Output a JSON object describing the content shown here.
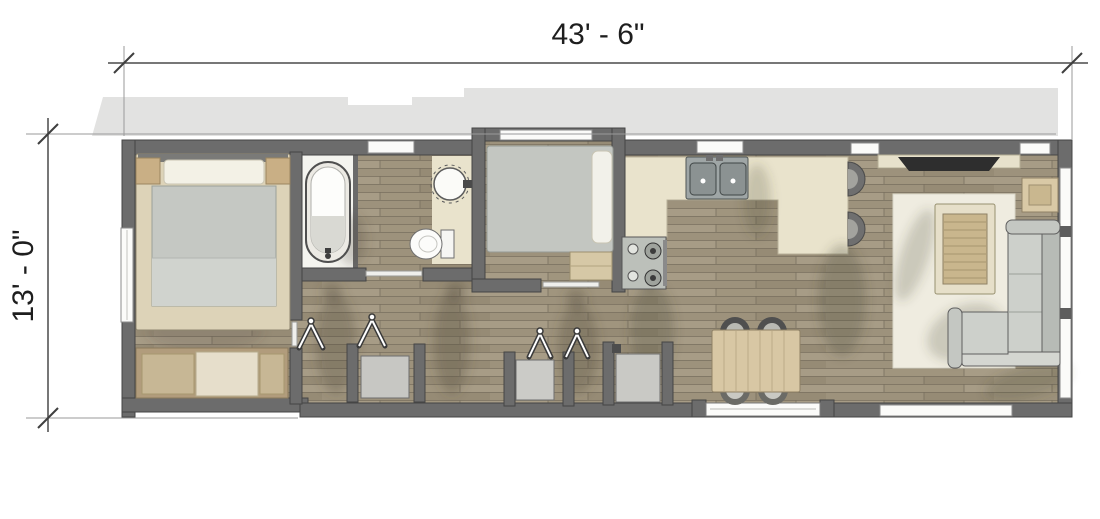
{
  "type": "floor-plan",
  "dimensions": {
    "width_label": "43' - 6\"",
    "height_label": "13' - 0\""
  },
  "colors": {
    "background": "#ffffff",
    "roof_outline": "#e2e2e1",
    "walls": "#6c6c6c",
    "wall_stroke": "#454545",
    "wood_floor": "#a79c86",
    "kitchen_counter": "#e9e3cc",
    "fixture_white": "#fbfbf9",
    "upholstery_grey": "#cdd0cb",
    "furniture_tan": "#d8c7a4",
    "rug": "#efece0",
    "shadow": "#4b473d",
    "tv_screen": "#2e2e2e"
  },
  "fixtures": [
    "bed",
    "pillows",
    "nightstand",
    "dresser",
    "bathtub",
    "vanity-sink",
    "toilet",
    "bunk-bed",
    "wardrobe-hanger",
    "closet",
    "washer",
    "kitchen-sink",
    "range-cooktop",
    "bar-counter",
    "bar-stool",
    "dining-table",
    "dining-chair",
    "entry-door",
    "window",
    "tv",
    "media-shelf",
    "end-table",
    "coffee-table",
    "rug",
    "sectional-sofa"
  ]
}
